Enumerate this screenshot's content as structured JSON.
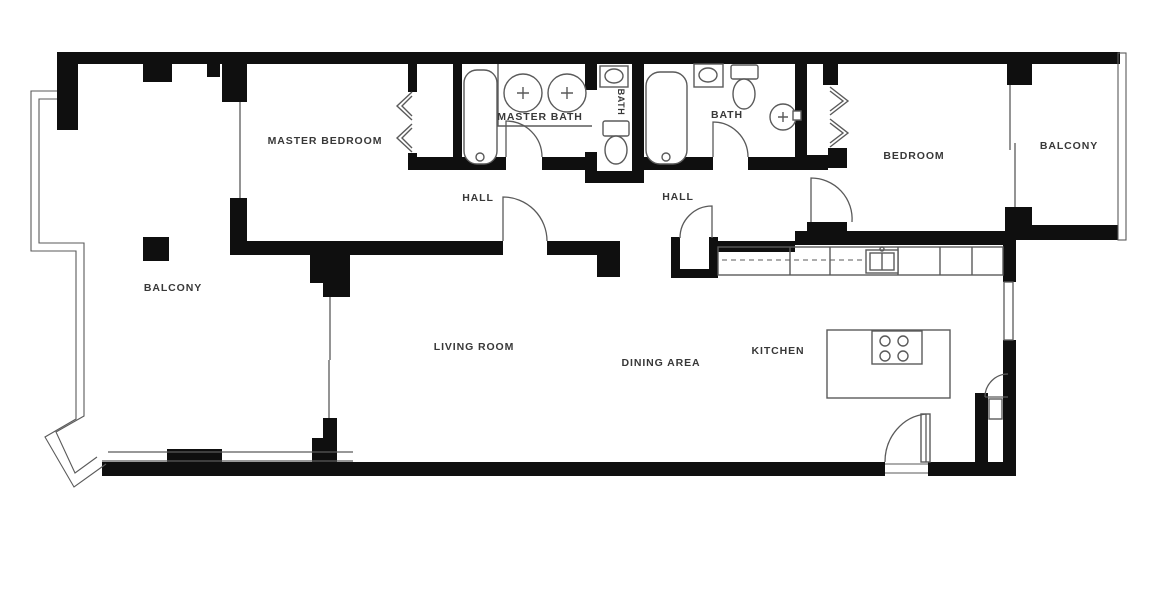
{
  "plan": {
    "background": "#ffffff",
    "wall_color": "#0f0f0f",
    "line_color": "#5a5a5a",
    "label_color": "#383838",
    "labels": {
      "master_bedroom": "MASTER BEDROOM",
      "master_bath": "MASTER BATH",
      "water_closet_bath": "BATH",
      "bath": "BATH",
      "hall_left": "HALL",
      "hall_right": "HALL",
      "bedroom": "BEDROOM",
      "balcony_upper_right": "BALCONY",
      "balcony_left": "BALCONY",
      "living_room": "LIVING ROOM",
      "dining_area": "DINING AREA",
      "kitchen": "KITCHEN"
    }
  }
}
